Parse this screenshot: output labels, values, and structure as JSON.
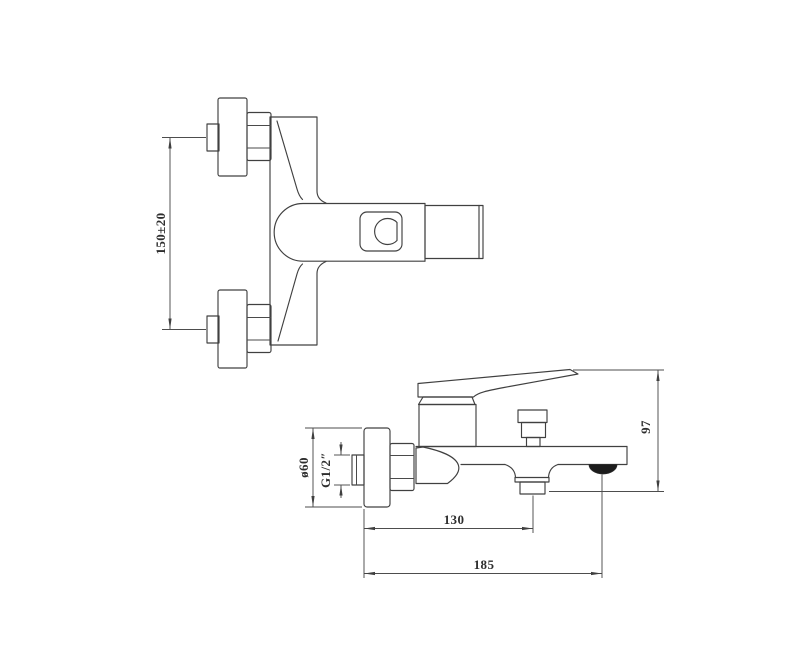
{
  "drawing": {
    "subject": "wall-mounted bath shower mixer faucet - dimension drawing",
    "colors": {
      "background": "#ffffff",
      "outline": "#404040",
      "dimension_lines": "#4d4d4d",
      "dimension_text": "#2e2e2e",
      "aerator_fill": "#1c1c1c"
    },
    "top_view": {
      "dim_mounting_centers": "150±20"
    },
    "side_view": {
      "dim_flange_diameter": "ø60",
      "dim_thread": "G1/2″",
      "dim_wall_to_shower_outlet": "130",
      "dim_wall_to_spout_outlet": "185",
      "dim_overall_height": "97"
    }
  }
}
